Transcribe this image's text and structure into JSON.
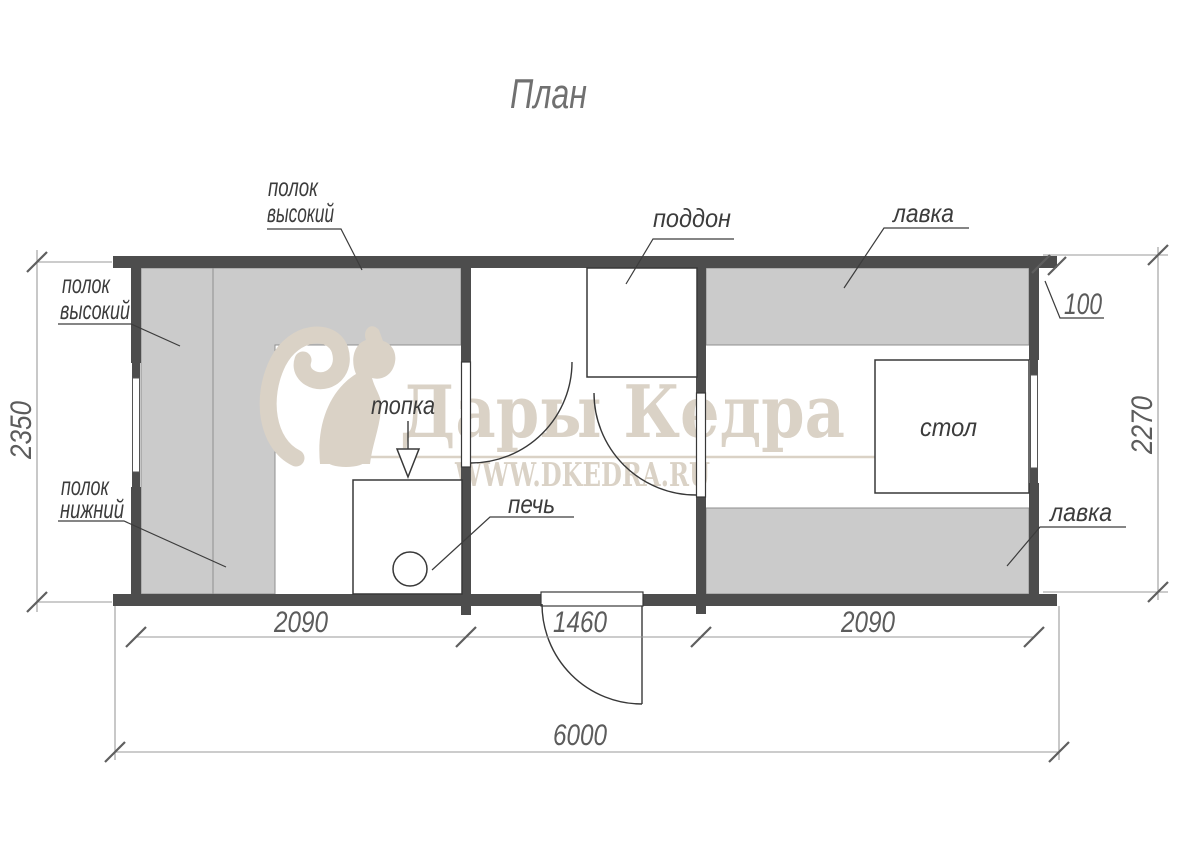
{
  "title": "План",
  "watermark": {
    "brand": "Дары Кедра",
    "url": "WWW.DKEDRA.RU",
    "color": "#dad2c6",
    "squirrel_icon": "squirrel-logo",
    "feather_icon": "cedar-branch"
  },
  "colors": {
    "wall": "#4d4d4d",
    "bench_fill": "#cbcbcb",
    "line": "#383838",
    "dimension": "#5c5c5c"
  },
  "labels": {
    "shelf_high_top": {
      "line1": "полок",
      "line2": "высокий"
    },
    "shelf_high_left": {
      "line1": "полок",
      "line2": "высокий"
    },
    "shelf_low_left": {
      "line1": "полок",
      "line2": "нижний"
    },
    "firebox": "топка",
    "stove": "печь",
    "shower_tray": "поддон",
    "bench_top": "лавка",
    "bench_bottom": "лавка",
    "table": "стол"
  },
  "dimensions": {
    "left_height": "2350",
    "right_height": "2270",
    "wall_overhang": "100",
    "steam_room_width": "2090",
    "washing_room_width": "1460",
    "rest_room_width": "2090",
    "total_width": "6000"
  }
}
